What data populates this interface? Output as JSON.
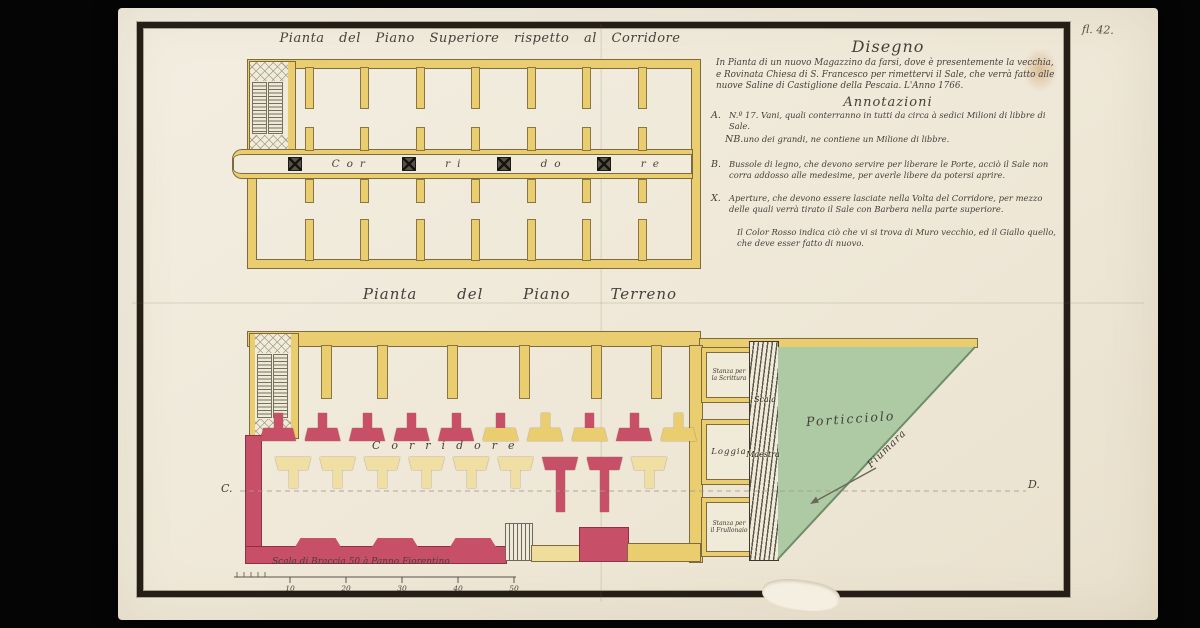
{
  "sheet": {
    "folio": "fl. 42.",
    "upper_plan_title": "Pianta del Piano Superiore rispetto al Corridore",
    "lower_plan_title": "Pianta del Piano Terreno"
  },
  "disegno": {
    "heading": "Disegno",
    "body": "In Pianta di un nuovo Magazzino da farsi, dove è presentemente la vecchia, e Rovinata Chiesa di S. Francesco per rimettervi il Sale, che verrà fatto alle nuove Saline di Castiglione della Pescaia. L'Anno 1766."
  },
  "annotazioni": {
    "heading": "Annotazioni",
    "items": [
      {
        "key": "A.",
        "text": "N.º 17. Vani, quali conterranno in tutti da circa à sedici Milioni di libbre di Sale."
      },
      {
        "key": "NB.",
        "text": "uno dei grandi, ne contiene un Milione di libbre."
      },
      {
        "key": "B.",
        "text": "Bussole di legno, che devono servire per liberare le Porte, acciò il Sale non corra addosso alle medesime, per averle libere da potersi aprire."
      },
      {
        "key": "X.",
        "text": "Aperture, che devono essere lasciate nella Volta del Corridore, per mezzo delle quali verrà tirato il Sale con Barbera nella parte superiore."
      },
      {
        "key": "",
        "text": "Il Color Rosso indica ciò che vi si trova di Muro vecchio, ed il Giallo quello, che deve esser fatto di nuovo."
      }
    ]
  },
  "upper_plan": {
    "corridor_segments": [
      "Cor",
      "ri",
      "do",
      "re"
    ]
  },
  "lower_plan": {
    "corridor_label": "Corridore",
    "upper_piers": [
      "old",
      "old",
      "old",
      "old",
      "old",
      "mixed",
      "new",
      "mixed",
      "old",
      "new"
    ],
    "lower_piers": [
      "new",
      "new",
      "new",
      "new",
      "new",
      "new",
      "old",
      "old",
      "new"
    ],
    "rooms": {
      "scrittura_line1": "Stanza per",
      "scrittura_line2": "la Scrittura",
      "loggia": "Loggia",
      "frullone_line1": "Stanza per",
      "frullone_line2": "il Frullonaio"
    },
    "stair_label_1": "Scala",
    "stair_label_2": "Maestra",
    "harbor_label": "Porticciolo",
    "river_label": "Fiumara",
    "section_left": "C.",
    "section_right": "D."
  },
  "scale_bar": {
    "label": "Scala di Braccia 50 à Panno Fiorentino",
    "ticks": [
      "10",
      "20",
      "30",
      "40",
      "50"
    ]
  },
  "colors": {
    "new_wall_yellow": "#e9cd6e",
    "old_wall_red": "#c84f68",
    "water_green": "#adcaa4",
    "ink": "#45403a",
    "paper": "#f0ead9",
    "frame": "#241e16"
  }
}
